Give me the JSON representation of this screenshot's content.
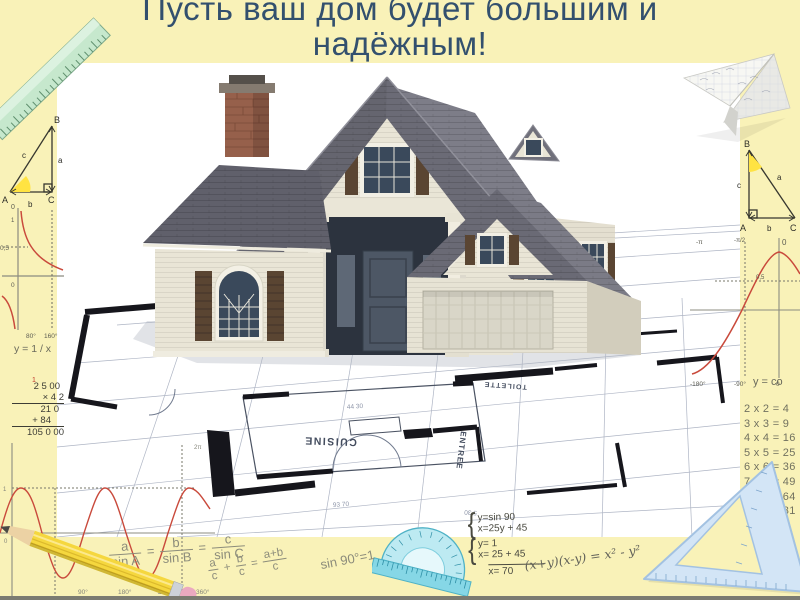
{
  "slide": {
    "title_line1": "Пусть ваш дом будет большим и",
    "title_line2": "надёжным!"
  },
  "photo": {
    "plan_labels": {
      "cuisine": "CUISINE",
      "entree": "ENTREE",
      "toilette": "TOILETTE"
    },
    "plan_dimensions": {
      "d1": "44 30",
      "d2": "93 70",
      "d3": "5 30"
    }
  },
  "left_column": {
    "triangle": {
      "v_a": "A",
      "v_b": "B",
      "v_c": "C",
      "s_a": "a",
      "s_b": "b",
      "s_c": "c"
    },
    "hyperbola": {
      "y_top": "0",
      "y_one": "1",
      "half": "0,5",
      "origin": "0",
      "x1": "80°",
      "x2": "160°",
      "caption": "y = 1 / x"
    },
    "long_multiplication": {
      "carry": "1",
      "row1": "2 5 00",
      "row2": "× 4 2",
      "row3": "21 0",
      "row4": "+ 84",
      "result": "105 0 00"
    },
    "sine": {
      "one": "1",
      "zero": "0",
      "top": "2π",
      "x1": "90°",
      "x2": "180°",
      "x3": "270°",
      "x4": "360°"
    }
  },
  "bottom": {
    "law_of_sines": {
      "n1": "a",
      "d1": "sin A",
      "eq": "=",
      "n2": "b",
      "d2": "sin B",
      "n3": "c",
      "d3": "sin C"
    },
    "fraction_sum": {
      "n1": "a",
      "d1": "c",
      "plus": "+",
      "n2": "b",
      "d2": "c",
      "eq": "=",
      "n3": "a+b",
      "d3": "c"
    },
    "sin_identity": "sin 90°=1",
    "systems": {
      "brace": "{",
      "s1l1": "y=sin 90",
      "s1l2": "x=25y + 45",
      "s2l1": "y= 1",
      "s2l2": "x= 25 + 45",
      "result": "x= 70"
    },
    "difference_of_squares": "(x+y)(x-y) = x² - y²"
  },
  "right_column": {
    "triangle": {
      "v_a": "A",
      "v_b": "B",
      "v_c": "C",
      "s_a": "a",
      "s_b": "b",
      "s_c": "c"
    },
    "cosine": {
      "pi": "-π",
      "pi_half": "-π/2",
      "zero_top": "0",
      "half": "0,5",
      "x1": "-180°",
      "x2": "-90°",
      "zero_bottom": "0",
      "caption": "y = co"
    },
    "times_table": [
      "2 x 2 = 4",
      "3 x 3 = 9",
      "4 x 4 = 16",
      "5 x 5 = 25",
      "6 x 6 = 36",
      "7 x 7 = 49",
      "8 x 8 = 64",
      "9 x 9 = 81"
    ]
  }
}
